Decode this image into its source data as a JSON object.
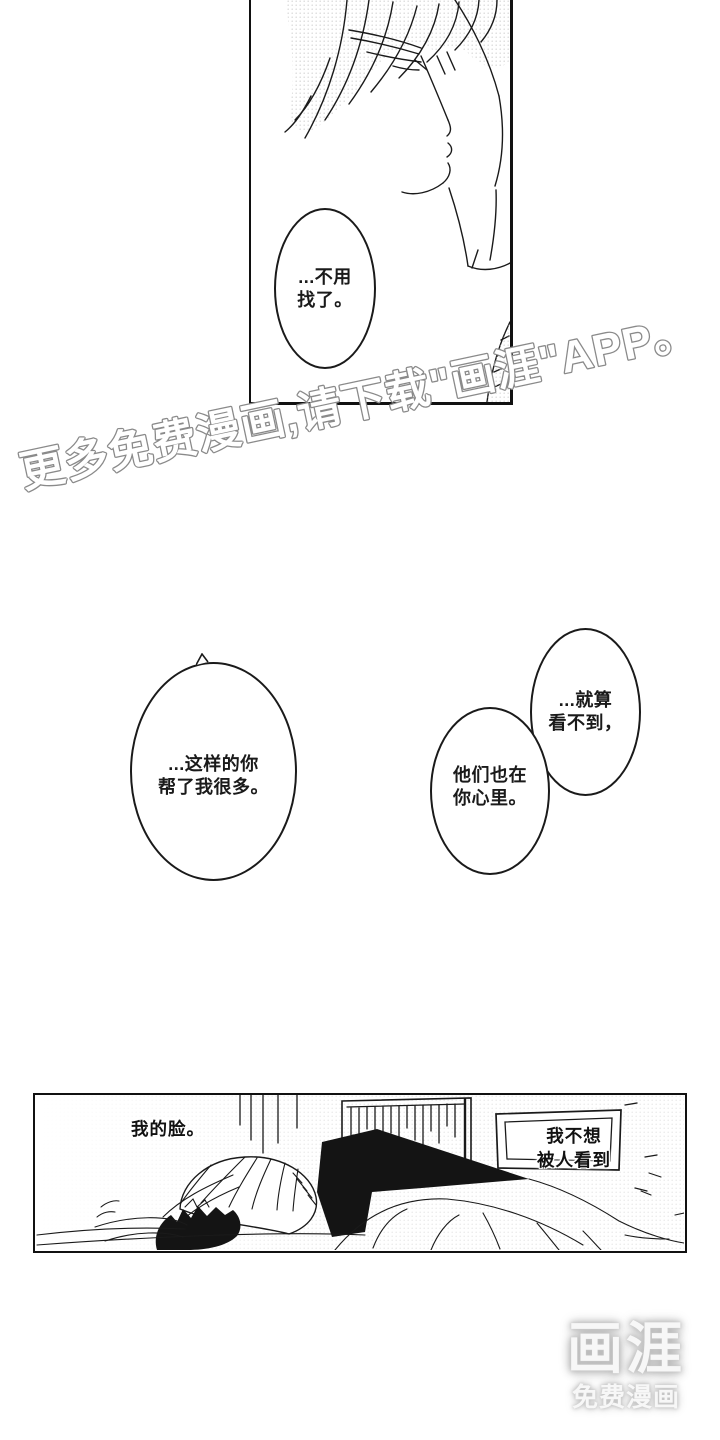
{
  "page": {
    "background": "#ffffff",
    "ink": "#1a1a1a"
  },
  "watermark": {
    "text": "更多免费漫画,请下载\"画涯\"APP。",
    "fill": "#ffffff",
    "outline": "#8a8a8a"
  },
  "panel_top": {
    "bubble": {
      "lines": [
        "...不用",
        "找了。"
      ]
    }
  },
  "panel_middle": {
    "bubble_left": {
      "lines": [
        "...这样的你",
        "帮了我很多。"
      ]
    },
    "bubble_right_top": {
      "lines": [
        "...就算",
        "看不到，"
      ]
    },
    "bubble_right_bottom": {
      "lines": [
        "他们也在",
        "你心里。"
      ]
    }
  },
  "panel_bottom": {
    "caption_left": "我的脸。",
    "caption_right": {
      "lines": [
        "我不想",
        "被人看到"
      ]
    }
  },
  "logo": {
    "title": "画涯",
    "subtitle": "免费漫画",
    "color": "#f7f7f7",
    "glow": "#b3b3b3"
  }
}
